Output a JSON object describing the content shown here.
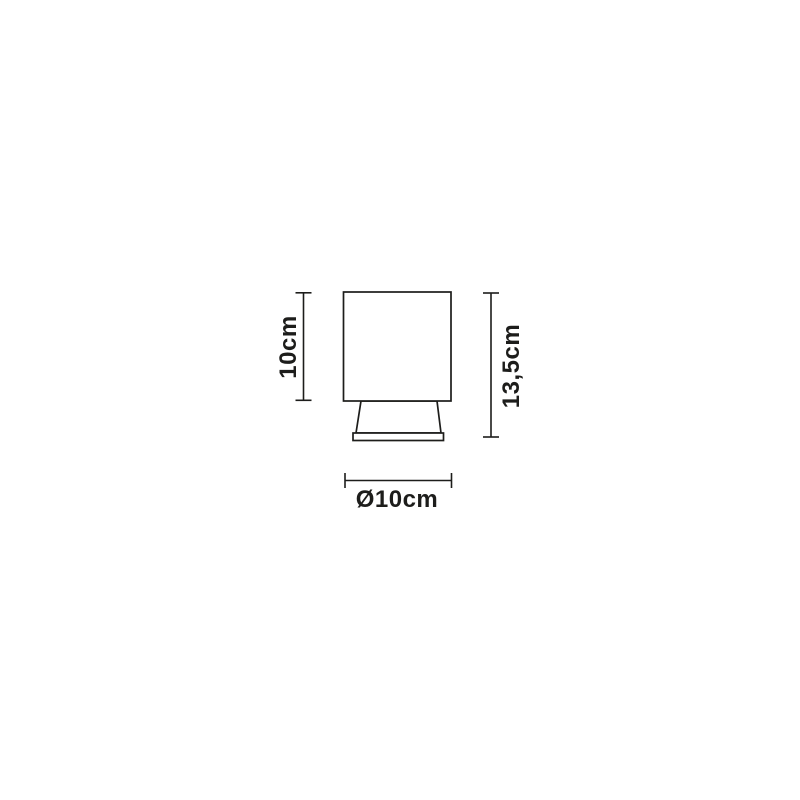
{
  "diagram": {
    "type": "product-dimension-drawing",
    "background_color": "#ffffff",
    "line_color": "#1d1d1b",
    "dimensions": {
      "shade_height": {
        "label": "10cm",
        "value_cm": 10,
        "orientation": "vertical",
        "side": "left"
      },
      "total_height": {
        "label": "13,5cm",
        "value_cm": 13.5,
        "orientation": "vertical",
        "side": "right"
      },
      "diameter": {
        "label": "Ø10cm",
        "value_cm": 10,
        "orientation": "horizontal",
        "side": "bottom"
      }
    }
  }
}
